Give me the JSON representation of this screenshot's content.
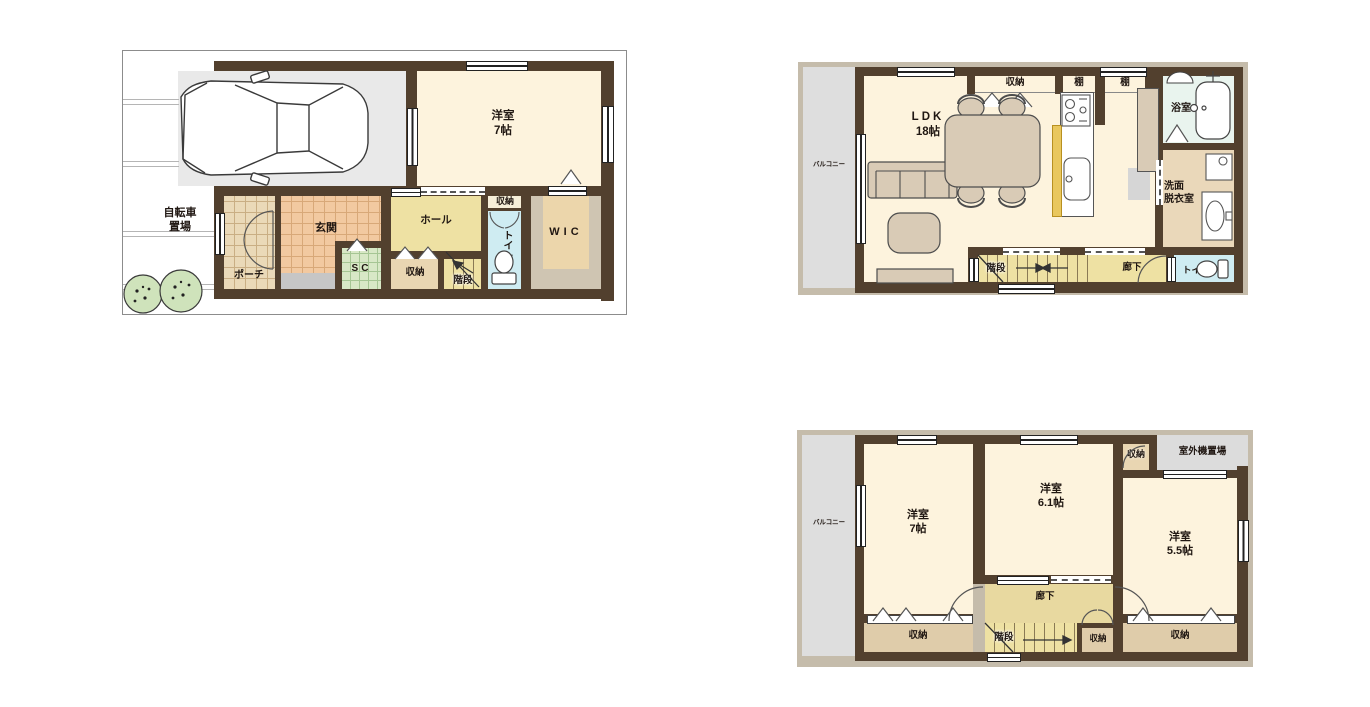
{
  "title": "3-story house floor plan",
  "colors": {
    "wall": "#52402e",
    "frame": "#c5bcab",
    "room_cream": "#fdf3dd",
    "garage_gray": "#e9e9e9",
    "balcony_gray": "#dedede",
    "hall_yellow": "#eee1a3",
    "storage_tan": "#e9d6b2",
    "toilet_blue": "#cfecf2",
    "bath_green": "#e9f4ee",
    "washroom_tan": "#ead8ba",
    "genkan_tile": "#f2c9a0",
    "sc_green": "#d8e8c6",
    "furniture_tan": "#d9cbb6",
    "counter_yellow": "#e9c75e",
    "tree_green": "#cfe3bb"
  },
  "floor1": {
    "bicycle_line1": "自転車",
    "bicycle_line2": "置場",
    "room7": {
      "name": "洋室",
      "size": "7帖"
    },
    "porch": "ポーチ",
    "genkan": "玄関",
    "sc": "SC",
    "hall": "ホール",
    "closet": "収納",
    "storage": "収納",
    "stairs": "階段",
    "toilet": "トイレ",
    "wic": "WIC"
  },
  "floor2": {
    "balcony": "バルコニー",
    "ldk": {
      "name": "LDK",
      "size": "18帖"
    },
    "closet": "収納",
    "shelf1": "棚",
    "shelf2": "棚",
    "bath": "浴室",
    "washroom_line1": "洗面",
    "washroom_line2": "脱衣室",
    "stairs": "階段",
    "corridor": "廊下",
    "toilet": "トイレ"
  },
  "floor3": {
    "balcony": "バルコニー",
    "room7": {
      "name": "洋室",
      "size": "7帖"
    },
    "room61": {
      "name": "洋室",
      "size": "6.1帖"
    },
    "room55": {
      "name": "洋室",
      "size": "5.5帖"
    },
    "closet_top": "収納",
    "outdoor_unit": "室外機置場",
    "corridor": "廊下",
    "stairs": "階段",
    "closet_left": "収納",
    "closet_mid": "収納",
    "closet_right": "収納"
  }
}
